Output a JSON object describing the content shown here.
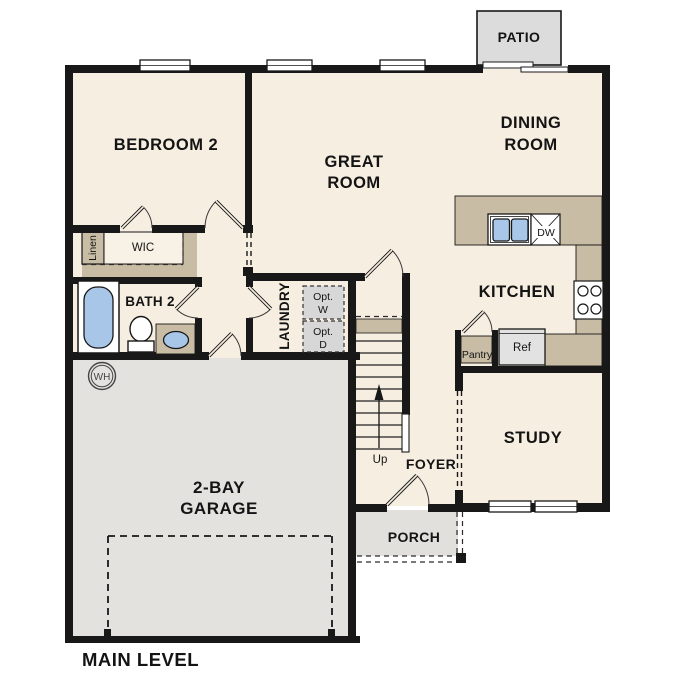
{
  "plan": {
    "title": "MAIN LEVEL"
  },
  "colors": {
    "wall": "#181818",
    "floor_cream": "#f6eee0",
    "garage_gray": "#e3e2df",
    "patio_gray": "#dcdcdc",
    "porch_gray": "#e1e0dd",
    "counter_tan": "#c9bca4",
    "fixture_blue": "#a8c7e8",
    "appliance_gray": "#e2e2e2",
    "option_gray": "#d7d7d7"
  },
  "rooms": {
    "bedroom2": "BEDROOM 2",
    "great_room": [
      "GREAT",
      "ROOM"
    ],
    "dining_room": [
      "DINING",
      "ROOM"
    ],
    "kitchen": "KITCHEN",
    "study": "STUDY",
    "foyer": "FOYER",
    "laundry": "LAUNDRY",
    "bath2": "BATH 2",
    "wic": "WIC",
    "linen": "Linen",
    "garage": [
      "2-BAY",
      "GARAGE"
    ],
    "porch": "PORCH",
    "patio": "PATIO"
  },
  "fixtures": {
    "pantry": "Pantry",
    "refrigerator": "Ref",
    "dishwasher": "DW",
    "water_heater": "WH",
    "optional_washer": [
      "Opt.",
      "W"
    ],
    "optional_dryer": [
      "Opt.",
      "D"
    ],
    "stair_direction": "Up"
  }
}
